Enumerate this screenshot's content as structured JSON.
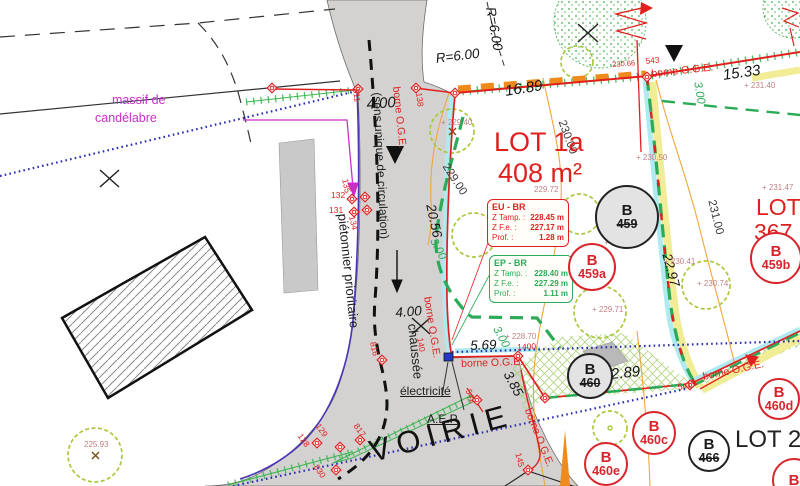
{
  "colors": {
    "boundary_red": "#e0201f",
    "division_green": "#2bab57",
    "contour_orange": "#f0a63c",
    "reserve_yellow": "#f3ec96",
    "network_cyan": "#aeeaf0",
    "pedestrian_blue": "#2b2bb6",
    "candelabra_magenta": "#cb2dcb",
    "road_gray": "#d3d2d0"
  },
  "lots": {
    "lot1a": {
      "name": "LOT 1a",
      "area": "408 m²"
    },
    "lot1b": {
      "name": "LOT 1b",
      "area": "367 m²"
    },
    "lot2": {
      "name": "LOT 2"
    }
  },
  "road": {
    "voirie": "VOIRIE",
    "sens_unique": "(sens unique de circulation)",
    "pietonnier": "piétonnier prioritaire",
    "chaussee": "chaussée",
    "electricite": "électricité",
    "aep": "A.E.P.",
    "massif_line1": "massif de",
    "massif_line2": "candélabre"
  },
  "borne_label": "borne O.G.E.",
  "borne_letter": "B",
  "eu_box": {
    "title": "EU - BR",
    "rows": [
      {
        "label": "Z Tamp. :",
        "value": "228.45 m"
      },
      {
        "label": "Z F.e. :",
        "value": "227.17 m"
      },
      {
        "label": "Prof. :",
        "value": "1.28 m"
      }
    ]
  },
  "ep_box": {
    "title": "EP - BR",
    "rows": [
      {
        "label": "Z Tamp. :",
        "value": "228.40 m"
      },
      {
        "label": "Z F.e. :",
        "value": "227.29 m"
      },
      {
        "label": "Prof. :",
        "value": "1.11 m"
      }
    ]
  },
  "borne_circles": [
    {
      "num": "459",
      "type": "black",
      "struck": true,
      "x": 627,
      "y": 217,
      "r": 32,
      "fill": "#e3e3e3"
    },
    {
      "num": "459a",
      "type": "red",
      "struck": false,
      "x": 592,
      "y": 267,
      "r": 24,
      "fill": "#fff"
    },
    {
      "num": "459b",
      "type": "red",
      "struck": false,
      "x": 776,
      "y": 258,
      "r": 26,
      "fill": "#fff"
    },
    {
      "num": "460",
      "type": "black",
      "struck": true,
      "x": 590,
      "y": 376,
      "r": 23,
      "fill": "#e3e3e3"
    },
    {
      "num": "460c",
      "type": "red",
      "struck": false,
      "x": 654,
      "y": 433,
      "r": 22,
      "fill": "#fff"
    },
    {
      "num": "460d",
      "type": "red",
      "struck": false,
      "x": 779,
      "y": 399,
      "r": 21,
      "fill": "#fff"
    },
    {
      "num": "466",
      "type": "black",
      "struck": true,
      "x": 709,
      "y": 451,
      "r": 21,
      "fill": "#fff"
    },
    {
      "num": "460e",
      "type": "red",
      "struck": false,
      "x": 606,
      "y": 464,
      "r": 22,
      "fill": "#fff"
    },
    {
      "num": "",
      "type": "red",
      "struck": false,
      "x": 794,
      "y": 480,
      "r": 22,
      "fill": "#fff"
    }
  ],
  "labels": [
    {
      "name": "dim-4-00-top",
      "text": "4.00",
      "x": 366,
      "y": 97,
      "rot": -4,
      "cls": "meas-lg"
    },
    {
      "name": "dim-16-89",
      "text": "16.89",
      "x": 504,
      "y": 84,
      "rot": -9,
      "cls": "meas-lg"
    },
    {
      "name": "dim-15-33",
      "text": "15.33",
      "x": 722,
      "y": 68,
      "rot": -8,
      "cls": "meas-lg"
    },
    {
      "name": "dim-20-56",
      "text": "20.56",
      "x": 437,
      "y": 203,
      "rot": 78,
      "cls": "meas"
    },
    {
      "name": "dim-4-00-mid",
      "text": "4.00",
      "x": 395,
      "y": 306,
      "rot": -4,
      "cls": "meas"
    },
    {
      "name": "dim-5-69",
      "text": "5.69",
      "x": 470,
      "y": 339,
      "rot": -2,
      "cls": "meas"
    },
    {
      "name": "dim-3-85",
      "text": "3.85",
      "x": 513,
      "y": 369,
      "rot": 62,
      "cls": "meas"
    },
    {
      "name": "dim-12-89",
      "text": "12.89",
      "x": 602,
      "y": 368,
      "rot": -6,
      "cls": "meas-lg"
    },
    {
      "name": "dim-22-97",
      "text": "22.97",
      "x": 673,
      "y": 252,
      "rot": 75,
      "cls": "meas"
    },
    {
      "name": "radius-r6-rotated",
      "text": "R=6.00",
      "x": 497,
      "y": 6,
      "rot": 80,
      "cls": "meas"
    },
    {
      "name": "radius-r6",
      "text": "R=6.00",
      "x": 435,
      "y": 52,
      "rot": -7,
      "cls": "meas"
    },
    {
      "name": "offset-3-00-a",
      "text": "3.00",
      "x": 437,
      "y": 237,
      "rot": 62,
      "cls": "green-m"
    },
    {
      "name": "offset-3-00-b",
      "text": "3.00",
      "x": 702,
      "y": 81,
      "rot": 80,
      "cls": "green-m"
    },
    {
      "name": "offset-3-00-c",
      "text": "3.00",
      "x": 500,
      "y": 325,
      "rot": 62,
      "cls": "green-m"
    },
    {
      "name": "contour-229",
      "text": "229.00",
      "x": 449,
      "y": 162,
      "rot": 57,
      "cls": "contour-l"
    },
    {
      "name": "contour-230",
      "text": "230.00",
      "x": 566,
      "y": 119,
      "rot": 70,
      "cls": "contour-l"
    },
    {
      "name": "contour-231",
      "text": "231.00",
      "x": 716,
      "y": 199,
      "rot": 76,
      "cls": "contour-l"
    },
    {
      "name": "spot-229-40",
      "text": "+ 229.40",
      "x": 441,
      "y": 119,
      "rot": 0,
      "cls": "elev"
    },
    {
      "name": "spot-230-66",
      "text": "230.66",
      "x": 612,
      "y": 61,
      "rot": -4,
      "cls": "elev-red"
    },
    {
      "name": "spot-231-40",
      "text": "+ 231.40",
      "x": 744,
      "y": 82,
      "rot": 0,
      "cls": "elev"
    },
    {
      "name": "spot-230-50",
      "text": "+ 230.50",
      "x": 636,
      "y": 154,
      "rot": 0,
      "cls": "elev"
    },
    {
      "name": "spot-229-72",
      "text": "229.72",
      "x": 534,
      "y": 186,
      "rot": 0,
      "cls": "elev"
    },
    {
      "name": "spot-229-83",
      "text": "+ 229.83",
      "x": 604,
      "y": 239,
      "rot": 0,
      "cls": "elev"
    },
    {
      "name": "spot-229-71",
      "text": "+ 229.71",
      "x": 592,
      "y": 306,
      "rot": 0,
      "cls": "elev"
    },
    {
      "name": "spot-230-41",
      "text": "+ 230.41",
      "x": 664,
      "y": 258,
      "rot": 0,
      "cls": "elev"
    },
    {
      "name": "spot-230-74",
      "text": "+ 230.74",
      "x": 697,
      "y": 280,
      "rot": 0,
      "cls": "elev"
    },
    {
      "name": "spot-231-47",
      "text": "+ 231.47",
      "x": 762,
      "y": 184,
      "rot": 0,
      "cls": "elev"
    },
    {
      "name": "spot-228-70",
      "text": "+ 228.70",
      "x": 505,
      "y": 333,
      "rot": 0,
      "cls": "elev"
    },
    {
      "name": "spot-225-93",
      "text": "225.93",
      "x": 84,
      "y": 441,
      "rot": 0,
      "cls": "elev"
    },
    {
      "name": "marker-543",
      "text": "543",
      "x": 645,
      "y": 57,
      "rot": -6,
      "cls": "rmk"
    },
    {
      "name": "marker-138",
      "text": "138",
      "x": 423,
      "y": 92,
      "rot": 83,
      "cls": "rmk"
    },
    {
      "name": "marker-811",
      "text": "811",
      "x": 360,
      "y": 88,
      "rot": 83,
      "cls": "rmk"
    },
    {
      "name": "marker-132",
      "text": "132",
      "x": 331,
      "y": 191,
      "rot": 0,
      "cls": "rmk"
    },
    {
      "name": "marker-131",
      "text": "131",
      "x": 329,
      "y": 206,
      "rot": 0,
      "cls": "rmk"
    },
    {
      "name": "marker-135",
      "text": "135",
      "x": 349,
      "y": 178,
      "rot": 78,
      "cls": "rmk"
    },
    {
      "name": "marker-134",
      "text": "134",
      "x": 356,
      "y": 215,
      "rot": 78,
      "cls": "rmk"
    },
    {
      "name": "marker-140",
      "text": "140",
      "x": 424,
      "y": 337,
      "rot": 80,
      "cls": "rmk"
    },
    {
      "name": "marker-816",
      "text": "816",
      "x": 377,
      "y": 341,
      "rot": 78,
      "cls": "rmk"
    },
    {
      "name": "marker-1400",
      "text": "1400",
      "x": 517,
      "y": 343,
      "rot": -3,
      "cls": "rmk"
    },
    {
      "name": "marker-542",
      "text": "542",
      "x": 472,
      "y": 388,
      "rot": 68,
      "cls": "rmk"
    },
    {
      "name": "marker-541",
      "text": "541",
      "x": 677,
      "y": 383,
      "rot": -10,
      "cls": "rmk"
    },
    {
      "name": "marker-145",
      "text": "145",
      "x": 522,
      "y": 452,
      "rot": 75,
      "cls": "rmk"
    },
    {
      "name": "marker-128",
      "text": "128",
      "x": 303,
      "y": 432,
      "rot": 55,
      "cls": "rmk"
    },
    {
      "name": "marker-129",
      "text": "129",
      "x": 321,
      "y": 422,
      "rot": 55,
      "cls": "rmk"
    },
    {
      "name": "marker-817",
      "text": "817",
      "x": 359,
      "y": 422,
      "rot": 55,
      "cls": "rmk"
    },
    {
      "name": "marker-830",
      "text": "830",
      "x": 319,
      "y": 463,
      "rot": 55,
      "cls": "rmk"
    },
    {
      "name": "borne-oge-top",
      "bind": "borne_label",
      "x": 651,
      "y": 69,
      "rot": -6,
      "cls": "borne"
    },
    {
      "name": "borne-oge-road-edge",
      "bind": "borne_label",
      "x": 401,
      "y": 86,
      "rot": 84,
      "cls": "borne"
    },
    {
      "name": "borne-oge-road-bottom",
      "bind": "borne_label",
      "x": 432,
      "y": 296,
      "rot": 81,
      "cls": "borne"
    },
    {
      "name": "borne-oge-frontage",
      "bind": "borne_label",
      "x": 461,
      "y": 359,
      "rot": -2,
      "cls": "borne"
    },
    {
      "name": "borne-oge-southeast",
      "bind": "borne_label",
      "x": 702,
      "y": 372,
      "rot": -12,
      "cls": "borne"
    },
    {
      "name": "borne-oge-south",
      "bind": "borne_label",
      "x": 532,
      "y": 407,
      "rot": 68,
      "cls": "borne"
    },
    {
      "name": "road-voirie",
      "bind": "road.voirie",
      "x": 366,
      "y": 437,
      "rot": -15,
      "cls": "voirie"
    },
    {
      "name": "road-sens-unique",
      "bind": "road.sens_unique",
      "x": 383,
      "y": 92,
      "rot": 87,
      "cls": "road12"
    },
    {
      "name": "road-pietonnier",
      "bind": "road.pietonnier",
      "x": 349,
      "y": 213,
      "rot": 84,
      "cls": "road13"
    },
    {
      "name": "road-chaussee",
      "bind": "road.chaussee",
      "x": 419,
      "y": 323,
      "rot": 84,
      "cls": "road13"
    },
    {
      "name": "note-electricite",
      "bind": "road.electricite",
      "x": 400,
      "y": 385,
      "rot": 0,
      "cls": "road12 u"
    },
    {
      "name": "note-aep",
      "bind": "road.aep",
      "x": 427,
      "y": 413,
      "rot": 0,
      "cls": "road12 u"
    },
    {
      "name": "note-massif-1",
      "bind": "road.massif_line1",
      "x": 112,
      "y": 94,
      "rot": 0,
      "cls": "magenta"
    },
    {
      "name": "note-massif-2",
      "bind": "road.massif_line2",
      "x": 95,
      "y": 112,
      "rot": 0,
      "cls": "magenta"
    },
    {
      "name": "lot1a-name",
      "bind": "lots.lot1a.name",
      "x": 494,
      "y": 129,
      "rot": 0,
      "cls": "lot"
    },
    {
      "name": "lot1a-area",
      "bind": "lots.lot1a.area",
      "x": 498,
      "y": 160,
      "rot": 0,
      "cls": "lot"
    },
    {
      "name": "lot1b-name",
      "bind": "lots.lot1b.name",
      "x": 756,
      "y": 196,
      "rot": 0,
      "cls": "lot-sm"
    },
    {
      "name": "lot1b-area",
      "bind": "lots.lot1b.area",
      "x": 754,
      "y": 221,
      "rot": 0,
      "cls": "lot-sm"
    },
    {
      "name": "lot2-name",
      "bind": "lots.lot2.name",
      "x": 735,
      "y": 428,
      "rot": 0,
      "cls": "lot2"
    }
  ]
}
